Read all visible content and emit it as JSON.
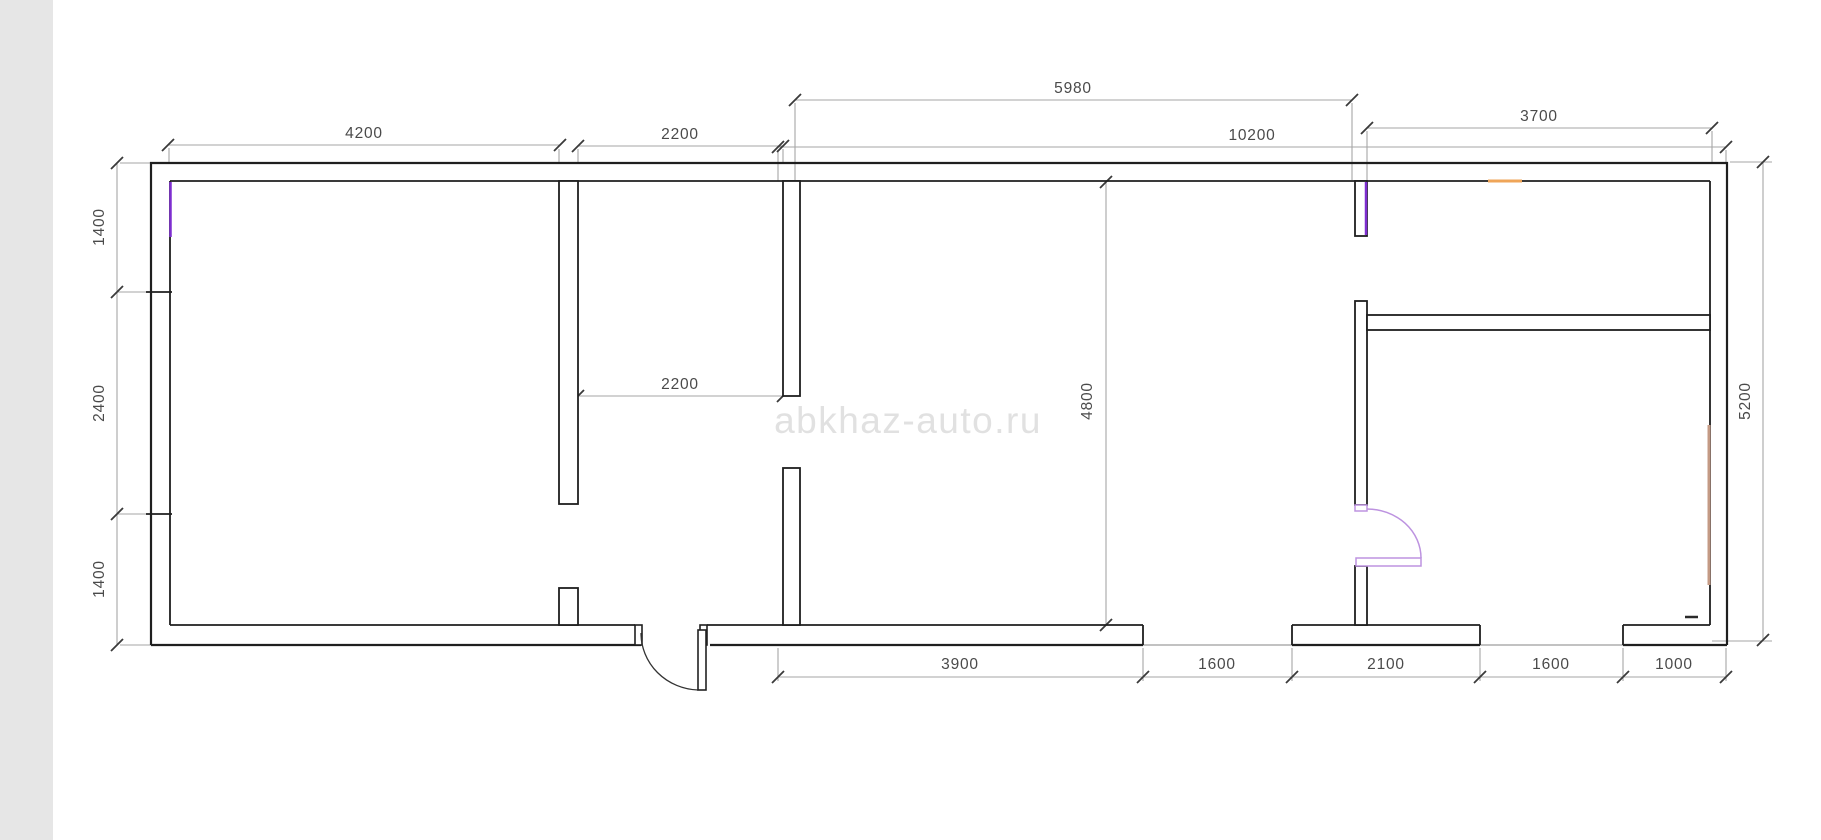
{
  "watermark": {
    "text": "abkhaz-auto.ru",
    "color": "#e1e1e1"
  },
  "dims": {
    "top_4200": "4200",
    "top_2200": "2200",
    "top_5980": "5980",
    "top_10200": "10200",
    "top_3700": "3700",
    "left_1400_top": "1400",
    "left_2400": "2400",
    "left_1400_bottom": "1400",
    "right_5200": "5200",
    "middle_4800": "4800",
    "inner_2200": "2200",
    "bottom_3900": "3900",
    "bottom_1600_left": "1600",
    "bottom_2100": "2100",
    "bottom_1600_right": "1600",
    "bottom_1000": "1000"
  },
  "dimension_chains": {
    "top": [
      "4200",
      "2200",
      "5980",
      "10200",
      "3700"
    ],
    "left": [
      "1400",
      "2400",
      "1400"
    ],
    "right": [
      "5200"
    ],
    "bottom": [
      "3900",
      "1600",
      "2100",
      "1600",
      "1000"
    ],
    "interior": [
      "2200",
      "4800"
    ]
  },
  "colors": {
    "wall_line": "#1f1f1f",
    "dimension_line": "#a6a6a6",
    "dimension_text": "#4a4a4a",
    "left_panel_bg": "#e6e6e6",
    "purple_mark": "#7e2ed0",
    "orange_mark": "#efa558",
    "tan_mark": "#c49a84",
    "interior_door": "#bd93e0"
  },
  "plan_notes": {
    "type": "floor-plan",
    "rooms_visible": 5,
    "doors": [
      "entrance-door-bottom",
      "interior-door-right"
    ],
    "window_openings_bottom": 2
  }
}
